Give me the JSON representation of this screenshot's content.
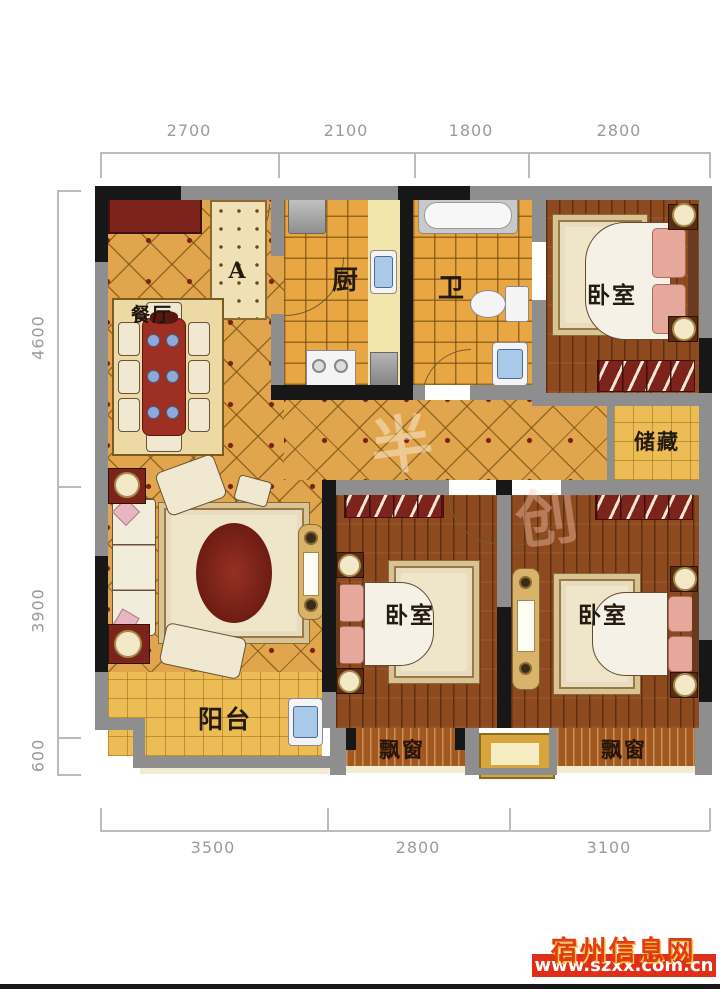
{
  "dimensions": {
    "top": [
      "2700",
      "2100",
      "1800",
      "2800"
    ],
    "left": [
      "4600",
      "3900",
      "600"
    ],
    "bottom": [
      "3500",
      "2800",
      "3100"
    ]
  },
  "rooms": {
    "dining": "餐厅",
    "kitchen": "厨",
    "bath": "卫",
    "bedroom_top_right": "卧室",
    "bedroom_bottom_middle": "卧室",
    "bedroom_bottom_right": "卧室",
    "storage": "储藏",
    "balcony": "阳台",
    "bay_window_middle": "飘窗",
    "bay_window_right": "飘窗",
    "entry_mat": "A"
  },
  "watermark": {
    "site_name": "宿州信息网",
    "site_url": "www.szxx.com.cn",
    "faint_glyphs": [
      "半",
      "创"
    ]
  },
  "colors": {
    "floor_gold": "#e1a54d",
    "floor_tile": "#e9a743",
    "floor_wood": "#8d4a1f",
    "floor_yellow": "#ecbc55",
    "wall_gray": "#8e8e8e",
    "wall_black": "#171717",
    "wardrobe_red": "#7c241c",
    "table_red": "#9e2f23",
    "pillow_pink": "#e7a89c",
    "watermark_red": "#e23c12",
    "banner_red": "#df2f18",
    "dim_text": "#9b9b9b"
  }
}
